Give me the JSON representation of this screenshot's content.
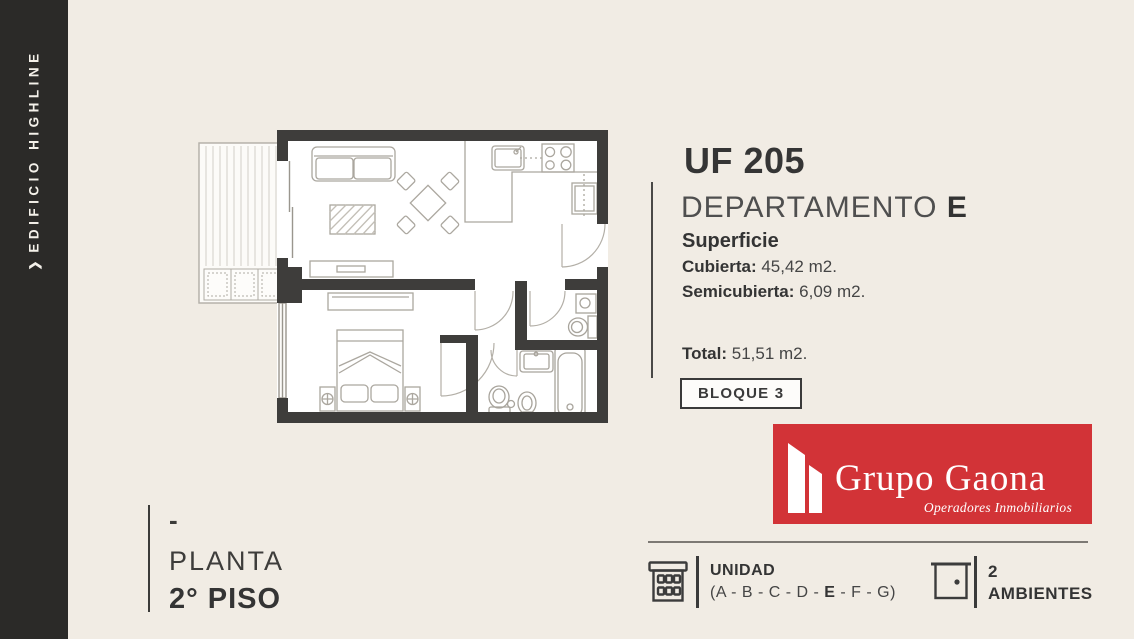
{
  "colors": {
    "background": "#f1ece4",
    "sidebar": "#2b2a28",
    "wall": "#3e3d3b",
    "accent_red": "#d23337",
    "text_dark": "#3a3a3a",
    "furniture_stroke": "#aeaaa2"
  },
  "sidebar": {
    "chevron": "❯",
    "title": "EDIFICIO HIGHLINE"
  },
  "info": {
    "unit_code": "UF 205",
    "department_label": "DEPARTAMENTO",
    "department_letter": "E",
    "surface_title": "Superficie",
    "surface_rows": [
      {
        "label": "Cubierta:",
        "value": " 45,42 m2."
      },
      {
        "label": "Semicubierta:",
        "value": " 6,09 m2."
      }
    ],
    "total_label": "Total:",
    "total_value": " 51,51 m2.",
    "block_badge": "BLOQUE 3"
  },
  "logo": {
    "company": "Grupo Gaona",
    "tagline": "Operadores Inmobiliarios"
  },
  "floor_label": {
    "dash": "-",
    "line1": "PLANTA",
    "line2": "2° PISO"
  },
  "footer": {
    "unidad_title": "UNIDAD",
    "units_prefix": "(A - B - C - D - ",
    "unit_selected": "E",
    "units_suffix": " - F - G)",
    "rooms_count": "2",
    "rooms_label": "AMBIENTES"
  }
}
